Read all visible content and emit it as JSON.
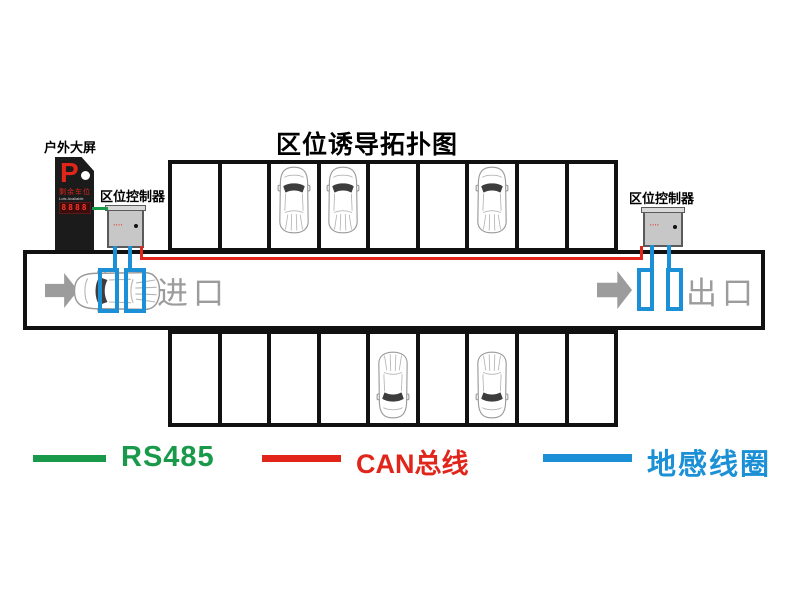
{
  "title": "区位诱导拓扑图",
  "outdoor_screen": {
    "label": "户外大屏",
    "p_letter": "P",
    "line1": "剩余车位",
    "line2": "Lots Available",
    "led_value": "8888"
  },
  "controllers": {
    "left": {
      "label": "区位控制器",
      "panel_marks": "▪▪▪▪"
    },
    "right": {
      "label": "区位控制器",
      "panel_marks": "▪▪▪▪"
    }
  },
  "lane": {
    "entrance_label": "进口",
    "exit_label": "出口"
  },
  "parking": {
    "top_row": {
      "spaces": 9,
      "occupied": [
        3,
        4,
        7
      ]
    },
    "bottom_row": {
      "spaces": 9,
      "occupied": [
        5,
        7
      ]
    }
  },
  "legend": [
    {
      "label": "RS485",
      "color": "#189a4a"
    },
    {
      "label": "CAN总线",
      "color": "#e1251b"
    },
    {
      "label": "地感线圈",
      "color": "#1b90d6"
    }
  ],
  "colors": {
    "rs485_line": "#189a4a",
    "can_line": "#e1251b",
    "coil_line": "#1b90d6",
    "structure": "#111111",
    "muted_gray": "#9c9c9c"
  }
}
